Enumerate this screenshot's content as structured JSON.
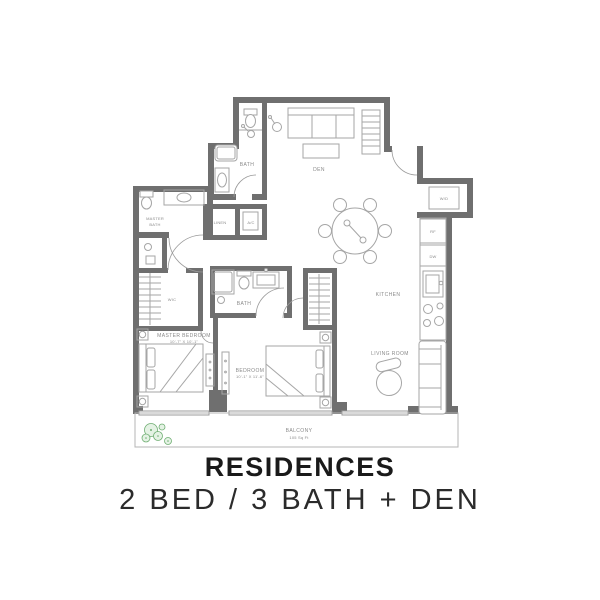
{
  "title": {
    "heading": "RESIDENCES",
    "subheading": "2 BED / 3 BATH + DEN"
  },
  "floorplan": {
    "labels": {
      "den": "DEN",
      "bath_upper": "BATH",
      "linen": "LINEN",
      "ac": "A/C",
      "wd": "W/D",
      "rf": "RF",
      "dw": "DW",
      "kitchen": "KITCHEN",
      "master_bath_1": "MASTER",
      "master_bath_2": "BATH",
      "wic": "WIC",
      "bath_middle": "BATH",
      "master_bedroom": "MASTER BEDROOM",
      "master_bedroom_dims": "10'-7\" X 10'-1\"",
      "bedroom": "BEDROOM",
      "bedroom_dims": "10'-1\" X 11'-6\"",
      "living_room": "LIVING ROOM",
      "balcony": "BALCONY",
      "balcony_area": "105 Sq Ft"
    },
    "colors": {
      "wall": "#6f6f6f",
      "fixture": "#a6a6a6",
      "label": "#8a8a8a",
      "plant_stroke": "#6fae72",
      "plant_fill": "#e4f2e4"
    }
  }
}
